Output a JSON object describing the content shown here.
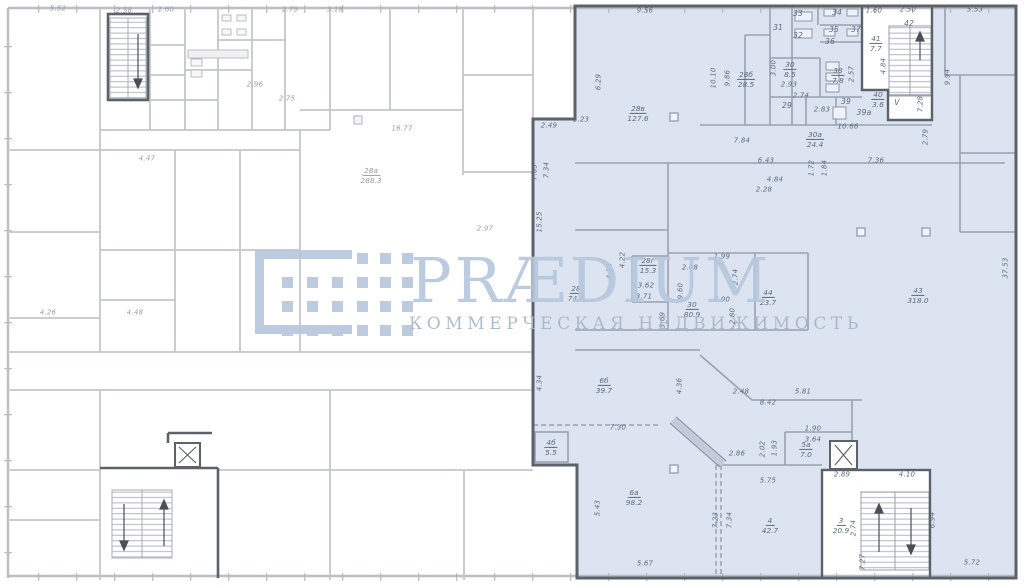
{
  "watermark": {
    "brand": "PRÆDIUM",
    "tagline": "КОММЕРЧЕСКАЯ НЕДВИЖИМОСТЬ"
  },
  "palette": {
    "highlight_fill": "#dce4f1",
    "highlight_border": "#5d6269",
    "watermark_blue": "#b7c7dd",
    "wall_gray": "#9aa2b2",
    "wall_light": "#c3c6cb"
  },
  "plan": {
    "rooms": [
      {
        "n": "41",
        "a": "7.7",
        "x": 876,
        "y": 40
      },
      {
        "n": "40",
        "a": "3.6",
        "x": 878,
        "y": 96
      },
      {
        "n": "30",
        "a": "8.5",
        "x": 790,
        "y": 66
      },
      {
        "n": "38",
        "a": "7.8",
        "x": 838,
        "y": 72
      },
      {
        "n": "28б",
        "a": "28.5",
        "x": 746,
        "y": 76
      },
      {
        "n": "28в",
        "a": "127.6",
        "x": 638,
        "y": 110
      },
      {
        "n": "30а",
        "a": "24.4",
        "x": 815,
        "y": 136
      },
      {
        "n": "28г",
        "a": "15.3",
        "x": 648,
        "y": 262
      },
      {
        "n": "28",
        "a": "74.5",
        "x": 576,
        "y": 290
      },
      {
        "n": "30",
        "a": "80.9",
        "x": 692,
        "y": 306
      },
      {
        "n": "44",
        "a": "23.7",
        "x": 768,
        "y": 294
      },
      {
        "n": "43",
        "a": "318.0",
        "x": 918,
        "y": 292
      },
      {
        "n": "6б",
        "a": "39.7",
        "x": 604,
        "y": 382
      },
      {
        "n": "4б",
        "a": "5.5",
        "x": 551,
        "y": 444
      },
      {
        "n": "5а",
        "a": "7.0",
        "x": 806,
        "y": 446
      },
      {
        "n": "6а",
        "a": "98.2",
        "x": 634,
        "y": 494
      },
      {
        "n": "4",
        "a": "42.7",
        "x": 770,
        "y": 522
      },
      {
        "n": "3",
        "a": "20.9",
        "x": 841,
        "y": 522
      },
      {
        "n": "28а",
        "a": "288.3",
        "x": 371,
        "y": 172,
        "w": true
      }
    ],
    "room_numbers": [
      {
        "t": "33",
        "x": 798,
        "y": 14
      },
      {
        "t": "34",
        "x": 837,
        "y": 13
      },
      {
        "t": "31",
        "x": 778,
        "y": 28
      },
      {
        "t": "32",
        "x": 798,
        "y": 36
      },
      {
        "t": "35",
        "x": 834,
        "y": 30
      },
      {
        "t": "37",
        "x": 856,
        "y": 30
      },
      {
        "t": "36",
        "x": 830,
        "y": 42
      },
      {
        "t": "29",
        "x": 787,
        "y": 106
      },
      {
        "t": "39",
        "x": 846,
        "y": 102
      },
      {
        "t": "39а",
        "x": 864,
        "y": 113
      },
      {
        "t": "42",
        "x": 909,
        "y": 24
      },
      {
        "t": "V",
        "x": 897,
        "y": 103
      }
    ],
    "dimensions": [
      {
        "t": "9.56",
        "x": 645,
        "y": 11
      },
      {
        "t": "1.60",
        "x": 874,
        "y": 11
      },
      {
        "t": "2.50",
        "x": 908,
        "y": 10
      },
      {
        "t": "5.53",
        "x": 975,
        "y": 10
      },
      {
        "t": "4.84",
        "x": 884,
        "y": 66,
        "r": 1
      },
      {
        "t": "7.28",
        "x": 921,
        "y": 104,
        "r": 1
      },
      {
        "t": "2.57",
        "x": 852,
        "y": 74,
        "r": 1
      },
      {
        "t": "3.00",
        "x": 774,
        "y": 68,
        "r": 1
      },
      {
        "t": "2.93",
        "x": 789,
        "y": 85
      },
      {
        "t": "2.74",
        "x": 801,
        "y": 96
      },
      {
        "t": "2.83",
        "x": 822,
        "y": 110
      },
      {
        "t": "10.66",
        "x": 848,
        "y": 127
      },
      {
        "t": "9.94",
        "x": 948,
        "y": 77,
        "r": 1
      },
      {
        "t": "2.79",
        "x": 926,
        "y": 137,
        "r": 1
      },
      {
        "t": "9.86",
        "x": 728,
        "y": 78,
        "r": 1
      },
      {
        "t": "10.10",
        "x": 714,
        "y": 78,
        "r": 1
      },
      {
        "t": "1.23",
        "x": 581,
        "y": 120
      },
      {
        "t": "2.49",
        "x": 549,
        "y": 126
      },
      {
        "t": "6.29",
        "x": 599,
        "y": 82,
        "r": 1
      },
      {
        "t": "7.03",
        "x": 535,
        "y": 172,
        "r": 1
      },
      {
        "t": "7.34",
        "x": 547,
        "y": 170,
        "r": 1
      },
      {
        "t": "15.25",
        "x": 540,
        "y": 222,
        "r": 1
      },
      {
        "t": "7.84",
        "x": 742,
        "y": 141
      },
      {
        "t": "6.43",
        "x": 766,
        "y": 161
      },
      {
        "t": "4.84",
        "x": 775,
        "y": 180
      },
      {
        "t": "2.28",
        "x": 764,
        "y": 190
      },
      {
        "t": "1.72",
        "x": 812,
        "y": 168,
        "r": 1
      },
      {
        "t": "1.84",
        "x": 825,
        "y": 168,
        "r": 1
      },
      {
        "t": "7.36",
        "x": 876,
        "y": 161
      },
      {
        "t": "4.22",
        "x": 623,
        "y": 260,
        "r": 1
      },
      {
        "t": "4.33",
        "x": 610,
        "y": 271,
        "r": 1
      },
      {
        "t": "3.62",
        "x": 646,
        "y": 286
      },
      {
        "t": "3.71",
        "x": 644,
        "y": 297
      },
      {
        "t": "2.08",
        "x": 690,
        "y": 268
      },
      {
        "t": "1.99",
        "x": 722,
        "y": 257
      },
      {
        "t": "2.74",
        "x": 736,
        "y": 277,
        "r": 1
      },
      {
        "t": "9.60",
        "x": 681,
        "y": 291,
        "r": 1
      },
      {
        "t": "7.00",
        "x": 722,
        "y": 300
      },
      {
        "t": "3.69",
        "x": 663,
        "y": 320,
        "r": 1
      },
      {
        "t": "2.80",
        "x": 733,
        "y": 316,
        "r": 1
      },
      {
        "t": "37.53",
        "x": 1006,
        "y": 268,
        "r": 1
      },
      {
        "t": "4.34",
        "x": 540,
        "y": 383,
        "r": 1
      },
      {
        "t": "4.36",
        "x": 680,
        "y": 386,
        "r": 1
      },
      {
        "t": "2.48",
        "x": 741,
        "y": 392
      },
      {
        "t": "5.81",
        "x": 803,
        "y": 392
      },
      {
        "t": "8.42",
        "x": 768,
        "y": 403
      },
      {
        "t": "7.30",
        "x": 618,
        "y": 428
      },
      {
        "t": "1.90",
        "x": 813,
        "y": 429
      },
      {
        "t": "3.64",
        "x": 813,
        "y": 440
      },
      {
        "t": "2.02",
        "x": 763,
        "y": 449,
        "r": 1
      },
      {
        "t": "1.93",
        "x": 775,
        "y": 448,
        "r": 1
      },
      {
        "t": "2.86",
        "x": 737,
        "y": 454
      },
      {
        "t": "5.75",
        "x": 768,
        "y": 481
      },
      {
        "t": "2.89",
        "x": 842,
        "y": 475
      },
      {
        "t": "5.43",
        "x": 598,
        "y": 508,
        "r": 1
      },
      {
        "t": "7.23",
        "x": 716,
        "y": 520,
        "r": 1
      },
      {
        "t": "7.34",
        "x": 730,
        "y": 520,
        "r": 1
      },
      {
        "t": "5.67",
        "x": 645,
        "y": 564
      },
      {
        "t": "4.10",
        "x": 907,
        "y": 475
      },
      {
        "t": "6.94",
        "x": 933,
        "y": 520,
        "r": 1
      },
      {
        "t": "5.72",
        "x": 972,
        "y": 563
      },
      {
        "t": "7.27",
        "x": 863,
        "y": 562,
        "r": 1
      },
      {
        "t": "2.74",
        "x": 854,
        "y": 528,
        "r": 1
      },
      {
        "t": "5.52",
        "x": 58,
        "y": 9,
        "w": 1
      },
      {
        "t": "2.58",
        "x": 124,
        "y": 11,
        "w": 1
      },
      {
        "t": "1.60",
        "x": 166,
        "y": 10,
        "w": 1
      },
      {
        "t": "2.79",
        "x": 290,
        "y": 10,
        "w": 1
      },
      {
        "t": "3.18",
        "x": 335,
        "y": 10,
        "w": 1
      },
      {
        "t": "16.77",
        "x": 402,
        "y": 129,
        "w": 1
      },
      {
        "t": "4.47",
        "x": 147,
        "y": 159,
        "w": 1
      },
      {
        "t": "2.96",
        "x": 255,
        "y": 85,
        "w": 1
      },
      {
        "t": "2.75",
        "x": 287,
        "y": 99,
        "w": 1
      },
      {
        "t": "4.26",
        "x": 48,
        "y": 313,
        "w": 1
      },
      {
        "t": "4.48",
        "x": 135,
        "y": 313,
        "w": 1
      },
      {
        "t": "2.97",
        "x": 485,
        "y": 229,
        "w": 1
      }
    ]
  }
}
